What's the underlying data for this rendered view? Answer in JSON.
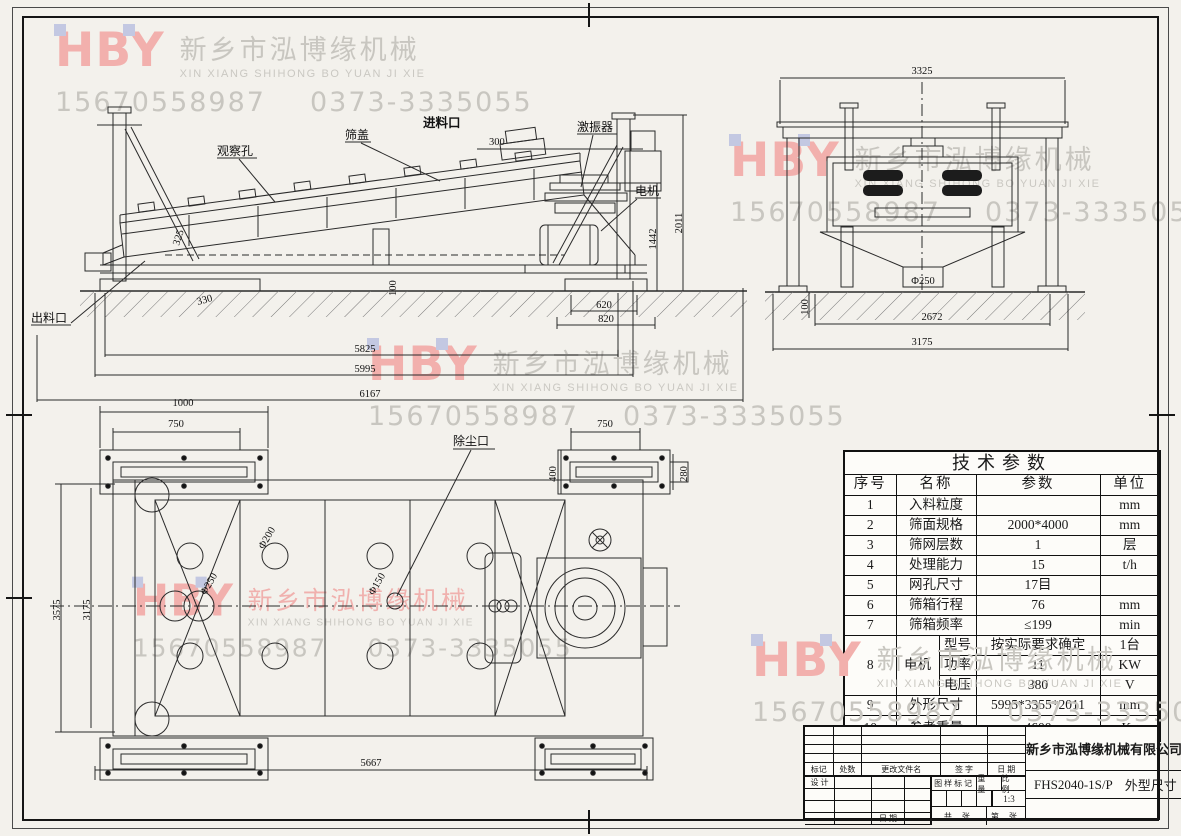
{
  "watermark": {
    "brand": "HBY",
    "company_cn": "新乡市泓博缘机械",
    "company_en": "XIN XIANG SHIHONG BO YUAN JI XIE",
    "phone_mobile": "15670558987",
    "phone_tel": "0373-3335055"
  },
  "side_view": {
    "labels": {
      "observation_hole": "观察孔",
      "screen_cover": "筛盖",
      "feed_inlet": "进料口",
      "exciter": "激振器",
      "motor": "电机",
      "discharge_outlet": "出料口"
    },
    "dims": {
      "feed_opening": "300",
      "box_height": "325",
      "d330": "330",
      "d100": "100",
      "d620": "620",
      "d820": "820",
      "d1442": "1442",
      "d2011": "2011",
      "d5825": "5825",
      "d5995": "5995",
      "d6167": "6167"
    }
  },
  "end_view": {
    "dims": {
      "width_top": "3325",
      "spout": "Φ250",
      "d100": "100",
      "inner": "2672",
      "outer": "3175"
    }
  },
  "plan_view": {
    "labels": {
      "dust_port": "除尘口"
    },
    "dims": {
      "d1000": "1000",
      "d750_left": "750",
      "d750_right": "750",
      "d400": "400",
      "d280": "280",
      "d3575": "3575",
      "d3175": "3175",
      "d5667": "5667",
      "hole_250": "Φ250",
      "hole_200": "Φ200",
      "hole_150": "Φ150"
    }
  },
  "params_table": {
    "title": "技术参数",
    "headers": [
      "序号",
      "名称",
      "参数",
      "单位"
    ],
    "rows": [
      {
        "no": "1",
        "name": "入料粒度",
        "value": "",
        "unit": "mm"
      },
      {
        "no": "2",
        "name": "筛面规格",
        "value": "2000*4000",
        "unit": "mm"
      },
      {
        "no": "3",
        "name": "筛网层数",
        "value": "1",
        "unit": "层"
      },
      {
        "no": "4",
        "name": "处理能力",
        "value": "15",
        "unit": "t/h"
      },
      {
        "no": "5",
        "name": "网孔尺寸",
        "value": "17目",
        "unit": ""
      },
      {
        "no": "6",
        "name": "筛箱行程",
        "value": "76",
        "unit": "mm"
      },
      {
        "no": "7",
        "name": "筛箱频率",
        "value": "≤199",
        "unit": "min"
      }
    ],
    "motor": {
      "no": "8",
      "name": "电机",
      "subs": [
        {
          "label": "型号",
          "value": "按实际要求确定",
          "unit": "1台"
        },
        {
          "label": "功率",
          "value": "11",
          "unit": "KW"
        },
        {
          "label": "电压",
          "value": "380",
          "unit": "V"
        }
      ]
    },
    "tail_rows": [
      {
        "no": "9",
        "name": "外形尺寸",
        "value": "5995*3355*2011",
        "unit": "mm"
      },
      {
        "no": "10",
        "name": "参考重量",
        "value": "4600",
        "unit": "Kg"
      }
    ]
  },
  "title_block": {
    "company": "新乡市泓博缘机械有限公司",
    "drawing_code": "FHS2040-1S/P",
    "drawing_name": "外型尺寸",
    "scale_value": "1:3",
    "labels": {
      "mark": "标记",
      "qty": "处数",
      "change_file": "更改文件名",
      "signature": "签 字",
      "date": "日 期",
      "design": "设 计",
      "date2": "日 期",
      "drawing_mark": "图样标记",
      "weight": "重 量",
      "scale": "比 例",
      "sheet_total": "共  张",
      "sheet_index": "第  张"
    }
  }
}
